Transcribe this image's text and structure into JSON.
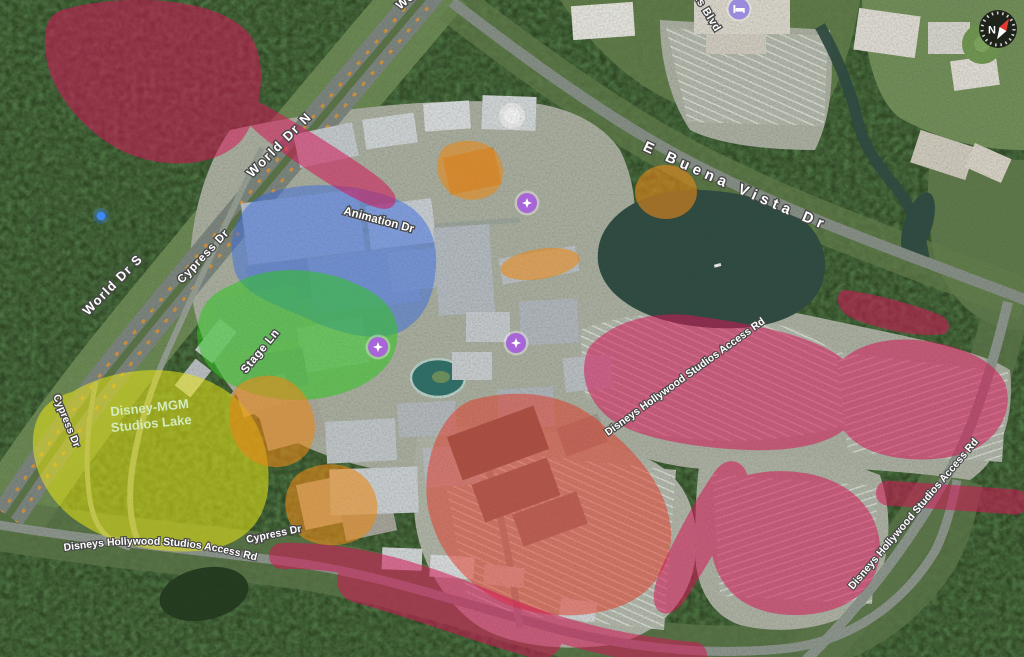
{
  "map": {
    "description": "Satellite map of Disney's Hollywood Studios with colored highlight zones",
    "road_labels": {
      "world_dr_n": "World Dr N",
      "world_dr_s": "World Dr S",
      "world_dr_partial": "World Dr N",
      "cypress_dr": "Cypress Dr",
      "animation_dr": "Animation Dr",
      "stage_ln": "Stage Ln",
      "e_buena_vista_dr": "E Buena Vista Dr",
      "resorts_blvd_partial": "rts Blvd",
      "access_rd": "Disneys Hollywood Studios Access Rd"
    },
    "water_labels": {
      "lake_line1": "Disney-MGM",
      "lake_line2": "Studios Lake"
    },
    "compass": {
      "north": "N"
    },
    "colors": {
      "overlay_pink": "#d31657",
      "overlay_red": "#e33322",
      "overlay_blue": "#3a6ce0",
      "overlay_green": "#2fc41f",
      "overlay_yellow": "#e8e616",
      "overlay_orange": "#e8891a",
      "marker_attraction": "#a765d8",
      "marker_hotel": "#9b8bdc",
      "poi_dot": "#3f87f5",
      "lake_label": "#d6eec6"
    },
    "icons": {
      "compass": "compass-icon",
      "attraction": "sparkle-icon",
      "hotel": "bed-icon",
      "location": "dot-icon"
    }
  }
}
